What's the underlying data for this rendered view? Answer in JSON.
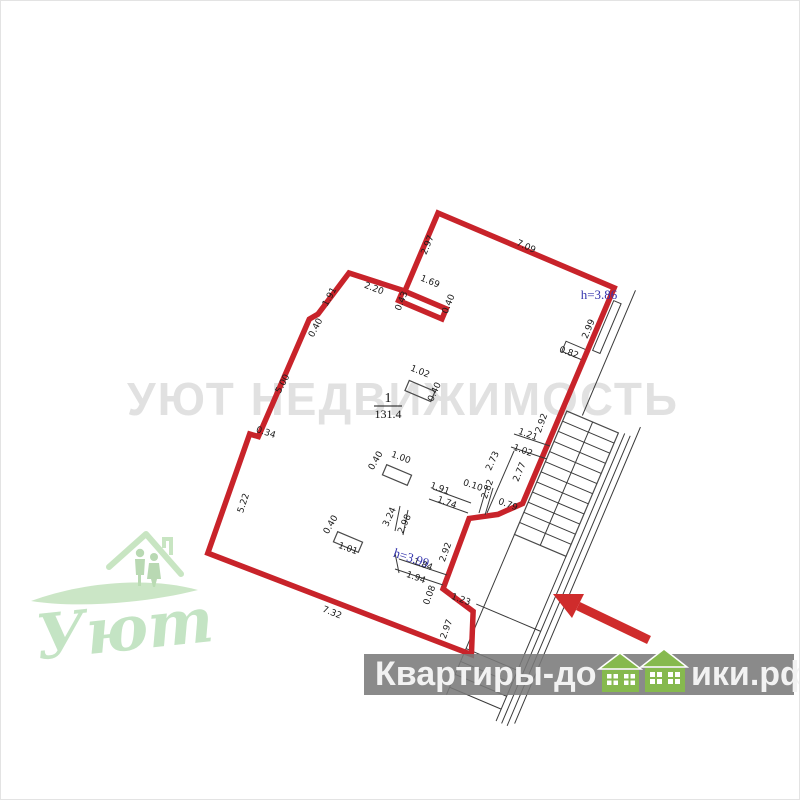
{
  "watermark": {
    "text": "УЮТ НЕДВИЖИМОСТЬ"
  },
  "logo": {
    "text": "Уют"
  },
  "banner": {
    "full_text": "Квартиры-домики.рф",
    "text_left": "Квартиры-до",
    "text_right": "ики.рф"
  },
  "room": {
    "number": "1",
    "area": "131.4"
  },
  "colors": {
    "outline_red": "#c8232a",
    "arrow_red": "#cf2c2c",
    "height_blue": "#3434ad",
    "banner_gray": "#7a7a7a",
    "house_green": "#86b94e",
    "logo_green": "#a9d7a9",
    "watermark_gray": "#c9c9c9"
  },
  "floorplan": {
    "height_labels": [
      {
        "t": "h=3.86",
        "x": 598,
        "y": 298,
        "r": 0
      },
      {
        "t": "h=3.99",
        "x": 409,
        "y": 561,
        "r": 18
      }
    ],
    "dimensions": [
      {
        "t": "2.97",
        "x": 429,
        "y": 245,
        "r": -67
      },
      {
        "t": "7.09",
        "x": 524,
        "y": 248,
        "r": 24
      },
      {
        "t": "1.69",
        "x": 428,
        "y": 283,
        "r": 22
      },
      {
        "t": "0.43",
        "x": 403,
        "y": 301,
        "r": -68
      },
      {
        "t": "0.40",
        "x": 450,
        "y": 304,
        "r": -68
      },
      {
        "t": "2.20",
        "x": 372,
        "y": 290,
        "r": 21
      },
      {
        "t": "1.91",
        "x": 331,
        "y": 297,
        "r": -62
      },
      {
        "t": "0.40",
        "x": 317,
        "y": 328,
        "r": -62
      },
      {
        "t": "5.00",
        "x": 284,
        "y": 384,
        "r": -62
      },
      {
        "t": "0.34",
        "x": 264,
        "y": 434,
        "r": 18
      },
      {
        "t": "5.22",
        "x": 245,
        "y": 503,
        "r": -72
      },
      {
        "t": "7.32",
        "x": 330,
        "y": 614,
        "r": 22
      },
      {
        "t": "2.97",
        "x": 448,
        "y": 629,
        "r": -70
      },
      {
        "t": "1.23",
        "x": 459,
        "y": 601,
        "r": 20
      },
      {
        "t": "0.08",
        "x": 431,
        "y": 595,
        "r": -70
      },
      {
        "t": "1.94",
        "x": 414,
        "y": 579,
        "r": 20
      },
      {
        "t": "1.84",
        "x": 421,
        "y": 566,
        "r": 20
      },
      {
        "t": "2.92",
        "x": 447,
        "y": 552,
        "r": -70
      },
      {
        "t": "2.98",
        "x": 406,
        "y": 524,
        "r": -65
      },
      {
        "t": "3.24",
        "x": 391,
        "y": 517,
        "r": -65
      },
      {
        "t": "0.40",
        "x": 332,
        "y": 525,
        "r": -60
      },
      {
        "t": "1.01",
        "x": 346,
        "y": 550,
        "r": 20
      },
      {
        "t": "0.40",
        "x": 377,
        "y": 461,
        "r": -60
      },
      {
        "t": "1.00",
        "x": 399,
        "y": 459,
        "r": 20
      },
      {
        "t": "1.02",
        "x": 418,
        "y": 373,
        "r": 22
      },
      {
        "t": "0.40",
        "x": 436,
        "y": 392,
        "r": -65
      },
      {
        "t": "1.74",
        "x": 445,
        "y": 504,
        "r": 20
      },
      {
        "t": "1.91",
        "x": 438,
        "y": 490,
        "r": 20
      },
      {
        "t": "0.10",
        "x": 471,
        "y": 487,
        "r": 18
      },
      {
        "t": "2.82",
        "x": 489,
        "y": 489,
        "r": -70
      },
      {
        "t": "2.73",
        "x": 494,
        "y": 461,
        "r": -65
      },
      {
        "t": "0.79",
        "x": 506,
        "y": 506,
        "r": 20
      },
      {
        "t": "2.77",
        "x": 521,
        "y": 472,
        "r": -67
      },
      {
        "t": "2.92",
        "x": 543,
        "y": 423,
        "r": -70
      },
      {
        "t": "1.21",
        "x": 526,
        "y": 436,
        "r": 20
      },
      {
        "t": "1.02",
        "x": 521,
        "y": 452,
        "r": 20
      },
      {
        "t": "0.82",
        "x": 567,
        "y": 354,
        "r": 20
      },
      {
        "t": "2.99",
        "x": 590,
        "y": 329,
        "r": -67
      }
    ]
  }
}
